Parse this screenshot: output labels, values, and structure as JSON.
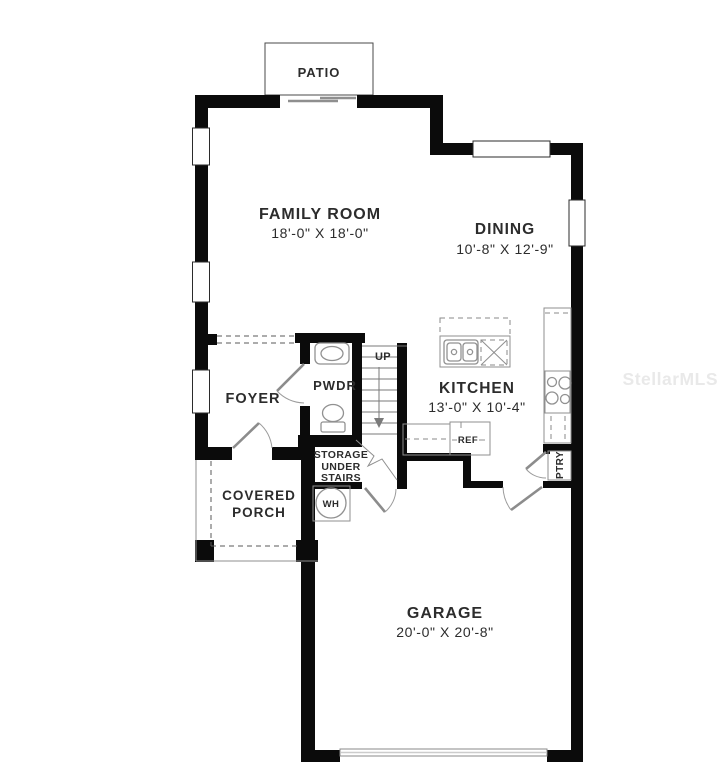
{
  "watermark": "StellarMLS",
  "colors": {
    "wall": "#0b0b0b",
    "thin_line": "#4a4a4a",
    "fixture_line": "#919191",
    "dashed_line": "#5a5a5a",
    "label_text": "#2c2c2c",
    "watermark_text": "#e9e9e9",
    "background": "#ffffff"
  },
  "plan": {
    "patio": {
      "label": "PATIO"
    },
    "family_room": {
      "label": "FAMILY ROOM",
      "dimensions": "18'-0\" X 18'-0\""
    },
    "dining": {
      "label": "DINING",
      "dimensions": "10'-8\" X 12'-9\""
    },
    "kitchen": {
      "label": "KITCHEN",
      "dimensions": "13'-0\" X 10'-4\""
    },
    "foyer": {
      "label": "FOYER"
    },
    "powder_room": {
      "label": "PWDR"
    },
    "covered_porch": {
      "line1": "COVERED",
      "line2": "PORCH"
    },
    "storage_under_stairs": {
      "line1": "STORAGE",
      "line2": "UNDER",
      "line3": "STAIRS"
    },
    "garage": {
      "label": "GARAGE",
      "dimensions": "20'-0\" X 20'-8\""
    },
    "stairs": {
      "label": "UP"
    },
    "refrigerator": {
      "label": "REF"
    },
    "pantry": {
      "label": "PTRY"
    },
    "water_heater": {
      "label": "WH"
    }
  }
}
